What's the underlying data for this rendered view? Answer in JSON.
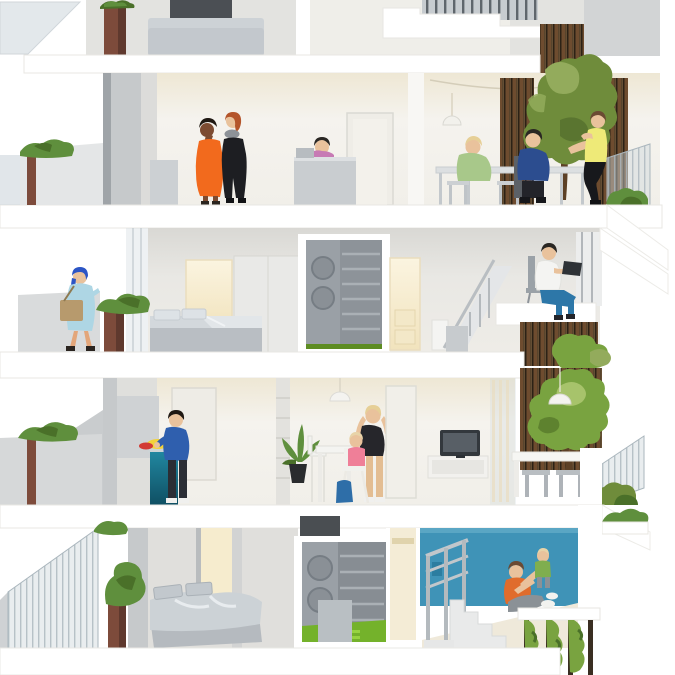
{
  "title": "Cross-section of a four-storey apartment building (architectural illustration)",
  "palette": {
    "background": "#ffffff",
    "slab_white": "#ffffff",
    "wall_warm": "#f2efe7",
    "wall_gray": "#c6c9cb",
    "accent_teal_wall": "#3f93b7",
    "kitchen_counter_teal": "#17718c",
    "green_floor": "#74b22b",
    "green_floor_light": "#97d340",
    "leaf_green": "#5f8f3d",
    "leaf_dark": "#4a7029",
    "leaf_light": "#93ab5c",
    "tree_olive": "#6f8c3b",
    "tree_green": "#79a340",
    "trunk_brown": "#5c4026",
    "slat_brown": "#6e4c2f",
    "slat_gap": "#2c2216",
    "planter_brown": "#7d4b3b",
    "glass_blue": "#cdd6dc",
    "warm_light": "#f6ecce",
    "skin_light": "#e9c29c",
    "skin_dark": "#7c4b31",
    "orange_dress": "#f26a1d",
    "orange_shirt": "#e06c2c",
    "yellow_shirt": "#eeea78",
    "green_sweater": "#a8c88a",
    "navy_shirt": "#2c4d8f",
    "blue_sweater": "#2f5fae",
    "jeans_blue": "#2d77a8",
    "coat_light_blue": "#aed6e4",
    "headscarf_blue": "#2c55c5",
    "bag_tan": "#b79a6d",
    "pink_top": "#c77ab4",
    "pink_child": "#ef7f98",
    "green_child": "#7fae4f",
    "black_clothing": "#1d1e22",
    "gray_pants": "#8b9196",
    "tv_screen": "#585f66"
  },
  "scene": {
    "floors": [
      {
        "label": "Top floor, partially visible: lounge sofa, balcony planter, stepped roof terrace with balustrade"
      },
      {
        "label": "Fourth floor: two women chatting, child at a desk, dining table with three people under pendant lamps, indoor tree against a timber-slat wall, terrace with glass railing"
      },
      {
        "label": "Third floor: woman with shopping bag on the walkway, bedroom with double bed and wardrobe, laundry closet with washer and dryer, staircase, man working on a laptop above a slatted planter wall"
      },
      {
        "label": "Second floor: man preparing food at a teal kitchen counter, potted plant, woman with toddler in a high chair, TV on a sideboard, terrace with outdoor table, tree and glass railing"
      },
      {
        "label": "First floor: bedroom with unmade bed, laundry closet with bright green floor, blue playroom with staircase where a father lifts his toddler, vertical garden hanging below"
      }
    ]
  }
}
